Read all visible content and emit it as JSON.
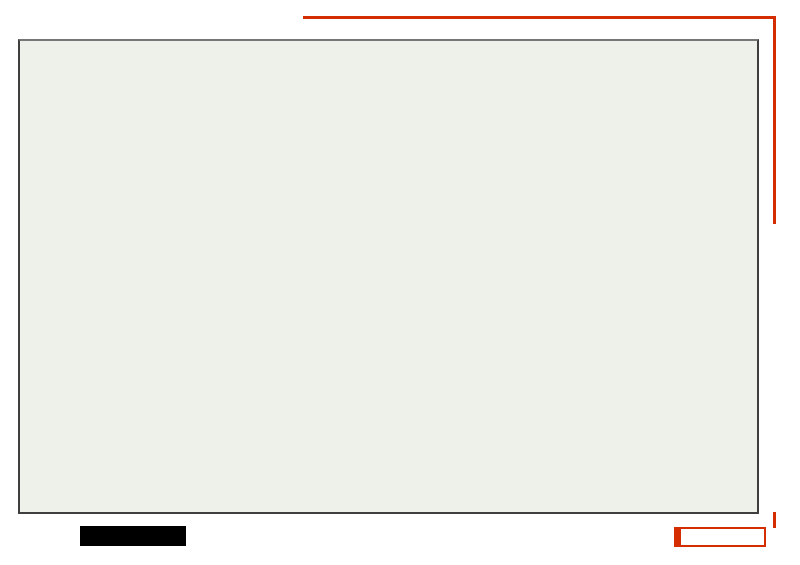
{
  "header": {
    "title": "HUBEISHENGJIAYUXIANRENMINGYIYUAN"
  },
  "right_panel": {
    "vertical_title": "湖北省嘉鱼县人民医院规划设计方案"
  },
  "footer": {
    "caption_label": "院区鸟瞰图",
    "section_label": "效果图部分",
    "date": "2009. 5"
  },
  "colors": {
    "accent_red": "#d42d00",
    "section_label_red": "#c53000",
    "caption_bg": "#000000",
    "caption_text": "#ffffff",
    "frame_border": "#3f3f3f",
    "red_cross": "#c1272d",
    "glass_corridor_blue": "#8fb6cc",
    "plaza_paving": "#e8e0cc",
    "field_green": "#72856a"
  },
  "icons": {
    "red_cross": "✚"
  }
}
